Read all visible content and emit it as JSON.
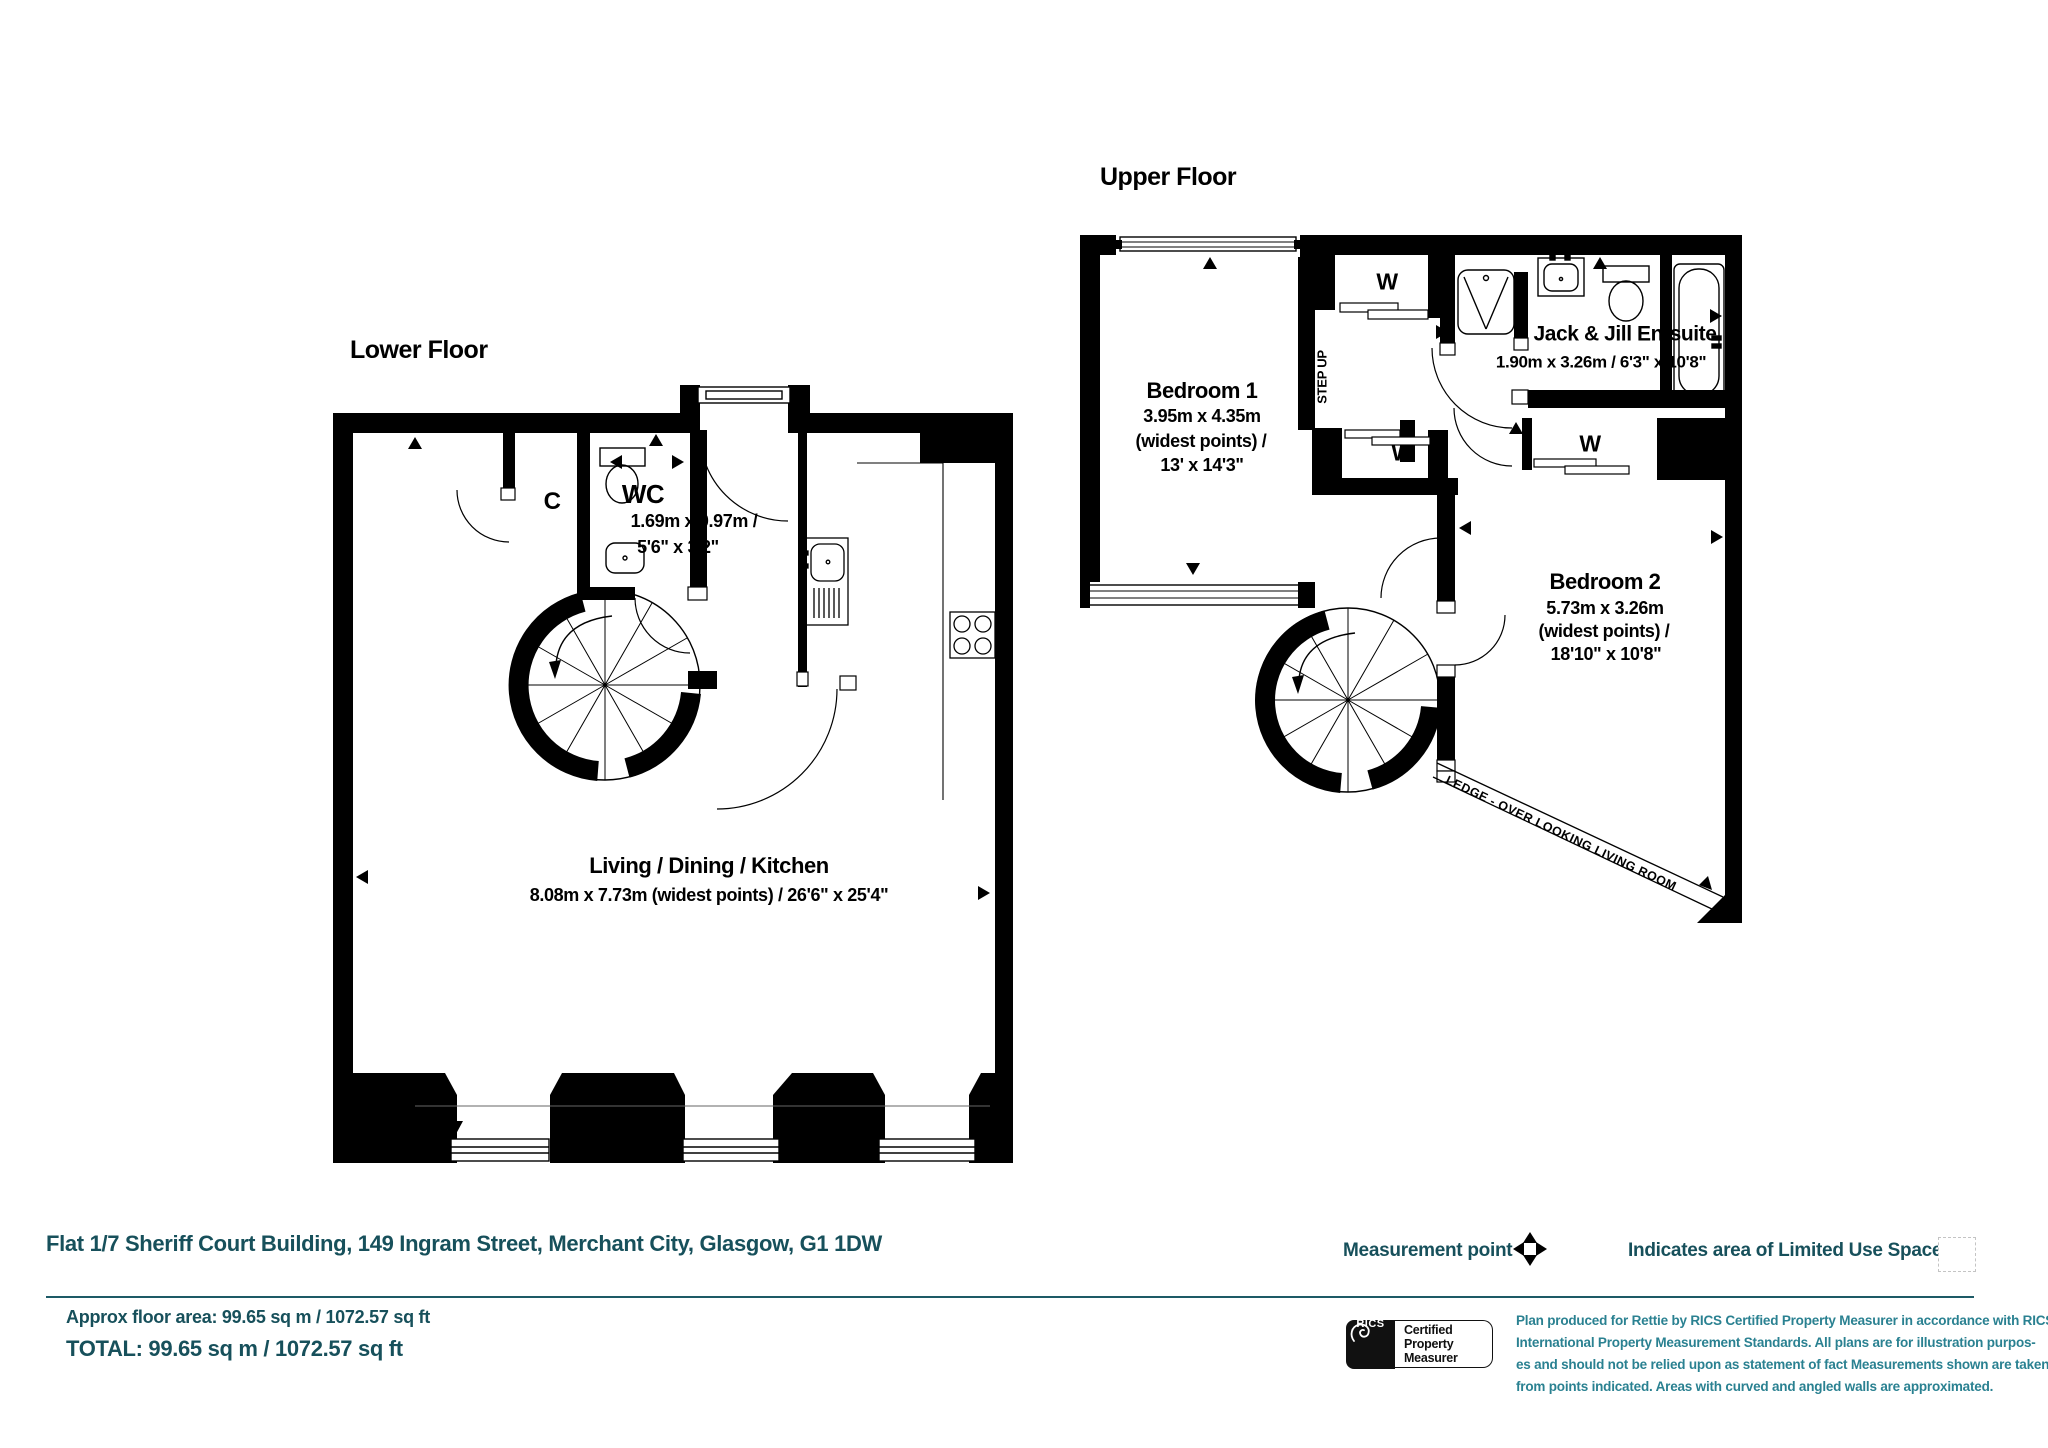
{
  "lower_floor": {
    "title": "Lower Floor",
    "rooms": {
      "cupboard": {
        "label": "C"
      },
      "wc": {
        "label": "WC",
        "dims_metric": "1.69m x 0.97m /",
        "dims_imperial": "5'6\" x 3'2\""
      },
      "living": {
        "label": "Living / Dining / Kitchen",
        "dims": "8.08m x 7.73m (widest points) / 26'6\" x 25'4\""
      }
    }
  },
  "upper_floor": {
    "title": "Upper Floor",
    "rooms": {
      "bedroom1": {
        "label": "Bedroom 1",
        "dims_metric": "3.95m x 4.35m",
        "dims_note": "(widest points) /",
        "dims_imperial": "13' x 14'3\""
      },
      "bedroom2": {
        "label": "Bedroom 2",
        "dims_metric": "5.73m x 3.26m",
        "dims_note": "(widest points) /",
        "dims_imperial": "18'10\" x 10'8\""
      },
      "ensuite": {
        "label": "Jack & Jill En-suite",
        "dims": "1.90m x 3.26m / 6'3\" x 10'8\""
      },
      "wardrobe1": {
        "label": "W"
      },
      "wardrobe2": {
        "label": "W"
      },
      "wardrobe3": {
        "label": "W"
      },
      "step_up": {
        "label": "STEP UP"
      },
      "ledge": {
        "label": "LEDGE - OVER LOOKING LIVING ROOM"
      }
    }
  },
  "footer": {
    "address": "Flat 1/7 Sheriff Court Building, 149 Ingram Street, Merchant City, Glasgow, G1 1DW",
    "legend": {
      "measurement_point": "Measurement point",
      "limited_use": "Indicates area of  Limited Use Space"
    },
    "approx_area": "Approx floor area: 99.65 sq m / 1072.57 sq ft",
    "total_area": "TOTAL: 99.65 sq m / 1072.57 sq ft",
    "rics_badge": {
      "org": "RICS",
      "certification": "Certified Property Measurer"
    },
    "disclaimer_lines": [
      "Plan produced for Rettie by RICS Certified Property Measurer in accordance with RICS",
      "International Property  Measurement Standards.  All plans are for illustration purpos-",
      "es and should not be relied upon as statement of fact Measurements shown are taken",
      "from points indicated. Areas with curved and angled walls are approximated."
    ]
  },
  "colors": {
    "plan_black": "#000000",
    "teal_dark": "#17505b",
    "teal_light": "#2a8191"
  }
}
